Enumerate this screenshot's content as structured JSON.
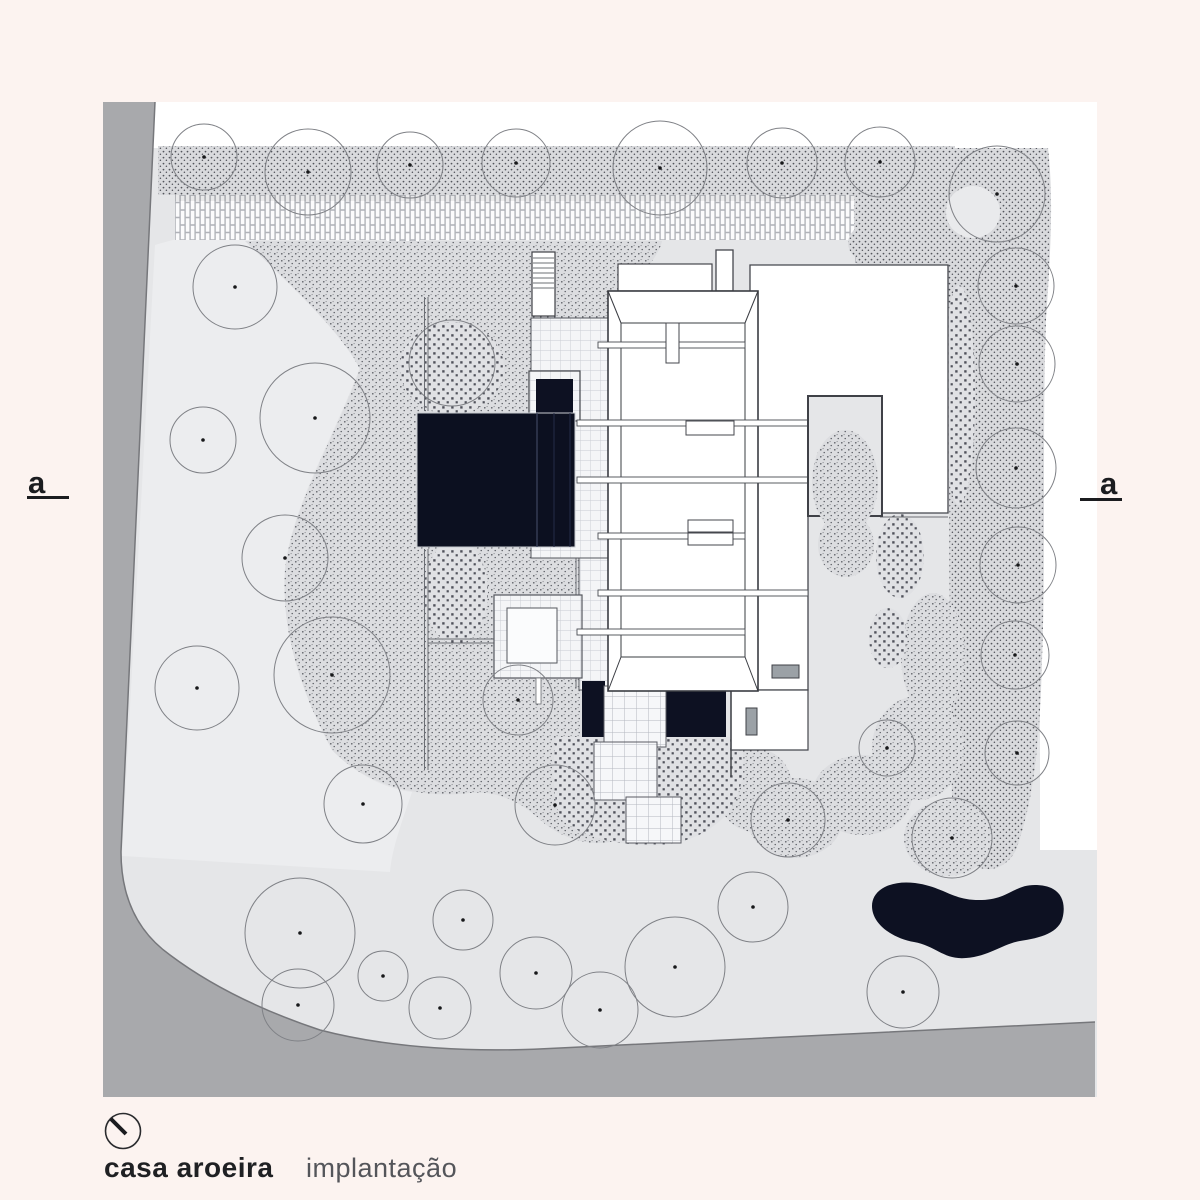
{
  "plan": {
    "title": "casa aroeira",
    "subtitle": "implantação",
    "section_marker_left": "a",
    "section_marker_right": "a",
    "scalebar": {
      "tick_labels": [
        "0",
        "1",
        "3",
        "5",
        "10",
        "20m"
      ]
    },
    "colors": {
      "page": "#fcf3f0",
      "site": "#e5e6e8",
      "road": "#a8a9ac",
      "water": "#0d1122",
      "ink": "#1f2023"
    }
  }
}
